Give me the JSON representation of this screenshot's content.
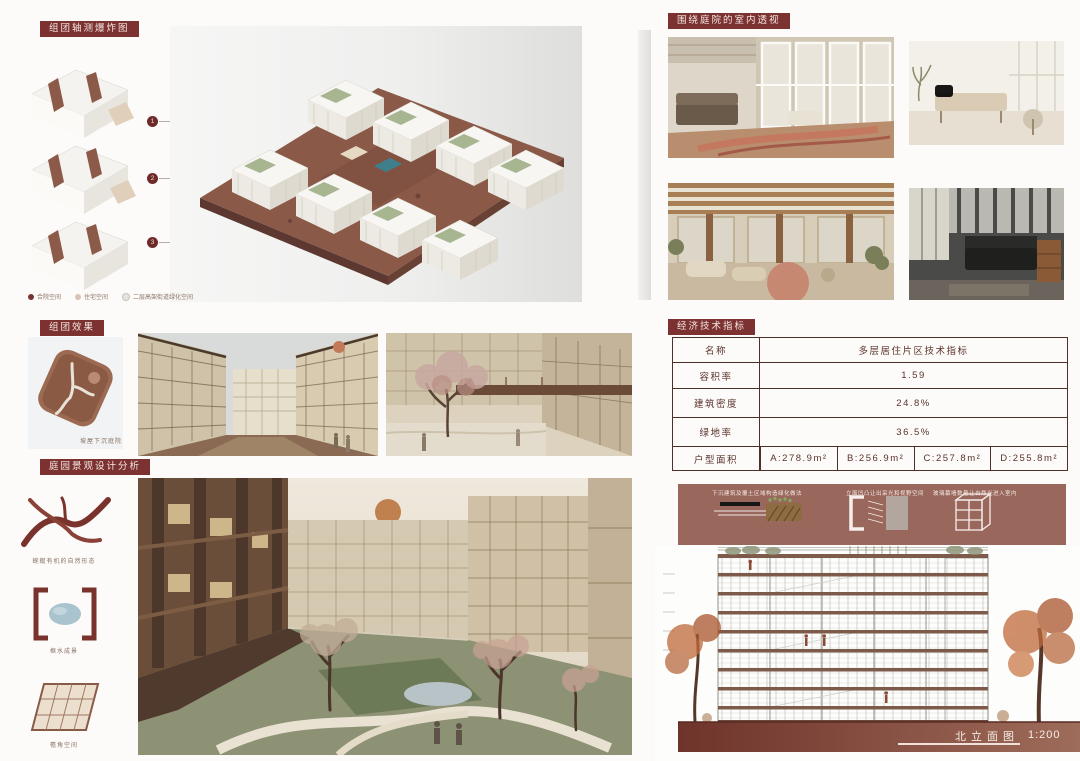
{
  "colors": {
    "accent_maroon": "#7d3232",
    "panel_brick": "#9a675c",
    "elevation_ground": "#7a3c32",
    "base_brown": "#8a5948"
  },
  "left": {
    "axon_section": {
      "label": "组团轴测爆炸图",
      "markers": [
        "1",
        "2",
        "3"
      ],
      "legend": [
        {
          "label": "合院空间"
        },
        {
          "label": "住宅空间"
        },
        {
          "label": "二层高架街道绿化空间"
        }
      ]
    },
    "group_section": {
      "label": "组团效果",
      "plan_caption": "坡屋下沉庭院"
    },
    "landscape_section": {
      "label": "庭园景观设计分析",
      "items": [
        {
          "caption": "蜿蜒有机的自然形态"
        },
        {
          "caption": "框水成景"
        },
        {
          "caption": "檐角空间"
        }
      ]
    }
  },
  "right": {
    "interior_section": {
      "label": "围绕庭院的室内透视"
    },
    "indicator_section": {
      "label": "经济技术指标",
      "table": {
        "rows": [
          {
            "name": "名称",
            "value": "多层居住片区技术指标"
          },
          {
            "name": "容积率",
            "value": "1.59"
          },
          {
            "name": "建筑密度",
            "value": "24.8%"
          },
          {
            "name": "绿地率",
            "value": "36.5%"
          }
        ],
        "area_row": {
          "name": "户型面积",
          "values": [
            "A:278.9m²",
            "B:256.9m²",
            "C:257.8m²",
            "D:255.8m²"
          ]
        }
      }
    },
    "elevation_section": {
      "details": [
        {
          "caption": "下沉建筑及覆土区域构造绿化做法"
        },
        {
          "caption": "立面凹凸让出采光和视野空间"
        },
        {
          "caption": "玻璃幕墙数量让自然光进入室内"
        }
      ],
      "drawing_title": "北立面图",
      "drawing_scale": "1:200"
    }
  }
}
